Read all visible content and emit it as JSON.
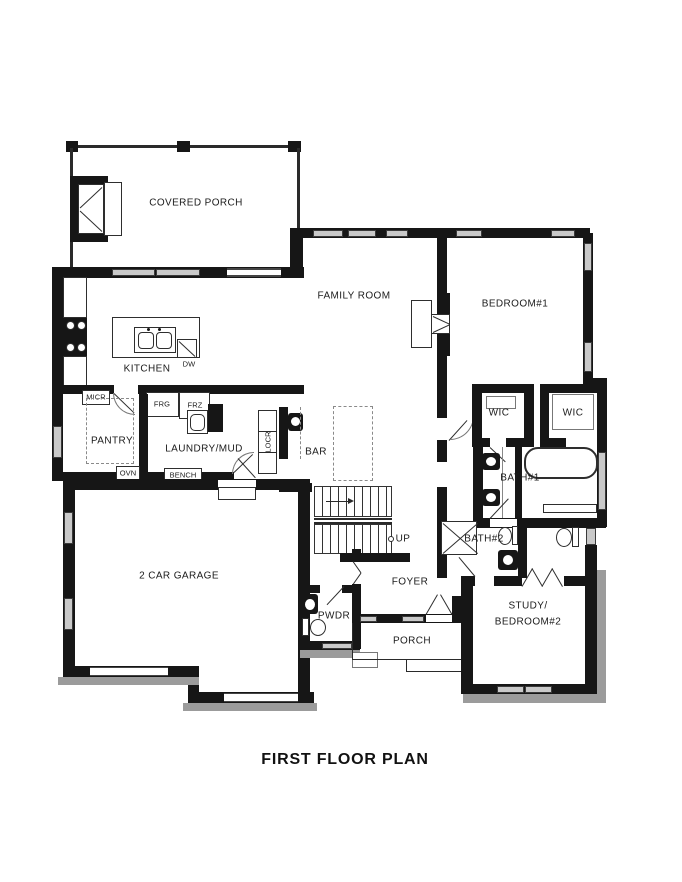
{
  "title": "FIRST FLOOR PLAN",
  "palette": {
    "wall": "#161616",
    "window_fill": "#c9c9c9",
    "siding": "#9b9b9b",
    "line": "#333333"
  },
  "rooms": {
    "covered_porch": "COVERED PORCH",
    "family_room": "FAMILY ROOM",
    "bedroom_1": "BEDROOM#1",
    "kitchen": "KITCHEN",
    "pantry": "PANTRY",
    "laundry_mud": "LAUNDRY/MUD",
    "bar": "BAR",
    "wic_left": "WIC",
    "wic_right": "WIC",
    "bath_1": "BATH#1",
    "bath_2": "BATH#2",
    "garage": "2 CAR GARAGE",
    "foyer": "FOYER",
    "pwdr": "PWDR",
    "porch": "PORCH",
    "study_line_1": "STUDY/",
    "study_line_2": "BEDROOM#2"
  },
  "annotations": {
    "micr": "MICR",
    "frg": "FRG",
    "frz": "FRZ",
    "ovn": "OVN",
    "bench": "BENCH",
    "locr": "LOCR",
    "dw": "DW",
    "up": "UP"
  }
}
